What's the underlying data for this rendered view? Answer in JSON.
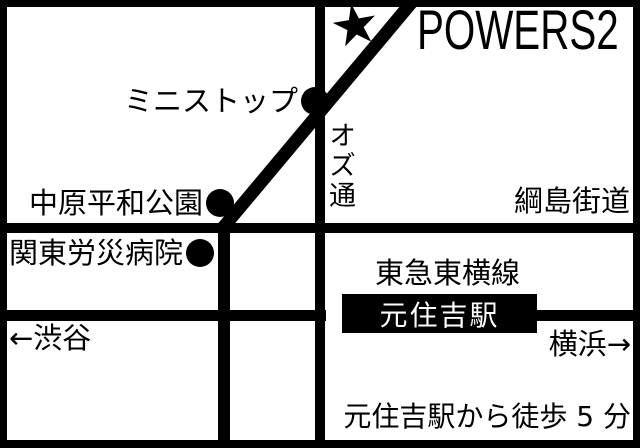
{
  "map": {
    "venue": {
      "name": "POWERS2",
      "star_icon": "★"
    },
    "pois": [
      {
        "id": "ministop",
        "label": "ミニストップ"
      },
      {
        "id": "nakahara-peace-park",
        "label": "中原平和公園"
      },
      {
        "id": "kanto-rosai-hospital",
        "label": "関東労災病院"
      }
    ],
    "roads": {
      "oz_street": "オズ通",
      "tsunashima_kaido": "綱島街道"
    },
    "railway": {
      "line_name": "東急東横線",
      "station": "元住吉駅",
      "direction_left": "←渋谷",
      "direction_right": "横浜→"
    },
    "note": "元住吉駅から徒歩 5 分",
    "colors": {
      "ink": "#000000",
      "background": "#ffffff",
      "station_text": "#ffffff"
    }
  }
}
